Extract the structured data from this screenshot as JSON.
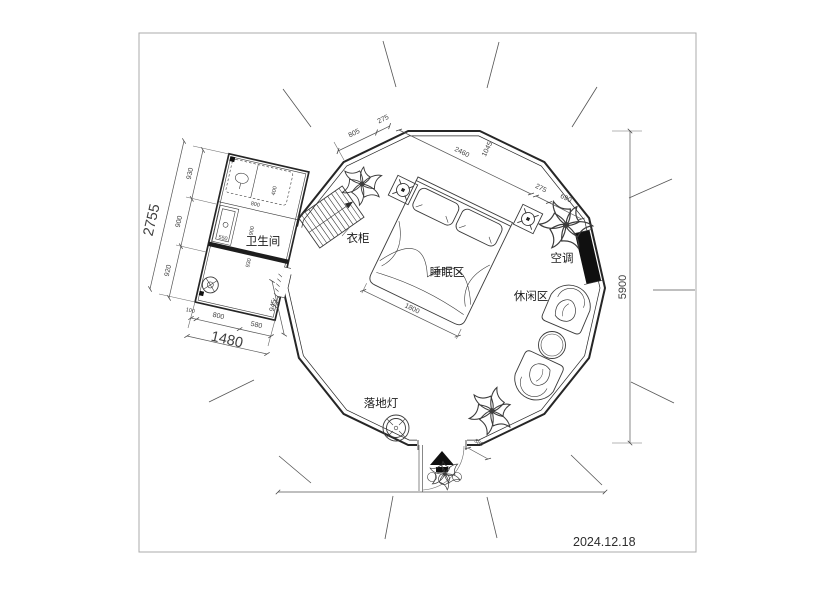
{
  "drawing": {
    "date": "2024.12.18",
    "labels": {
      "bathroom": "卫生间",
      "wardrobe": "衣柜",
      "sleeping_area": "睡眠区",
      "leisure_area": "休闲区",
      "air_conditioner": "空调",
      "floor_lamp": "落地灯"
    },
    "dimensions": {
      "overall_height": "5900",
      "bath_side_total": "2755",
      "bath_side_segments": [
        "930",
        "900",
        "920"
      ],
      "bath_front_total": "1480",
      "bath_front_segments": [
        "100",
        "800",
        "580"
      ],
      "bath_inner_tray": "550",
      "bath_inner_a": "900",
      "bath_inner_b": "930",
      "bath_inner_c": "800",
      "bath_inner_d": "400",
      "passage_width": "945",
      "wall_top_a": "805",
      "wall_top_b": "275",
      "bed_run": "2460",
      "bed_head_offset": "1045",
      "wall_right_a": "275",
      "wall_right_b": "690",
      "bed_width": "1800",
      "entrance_step": "380"
    }
  },
  "colors": {
    "wall_line": "#262626",
    "dim_line": "#555555",
    "solid_fill": "#101010",
    "frame": "#ababab"
  }
}
